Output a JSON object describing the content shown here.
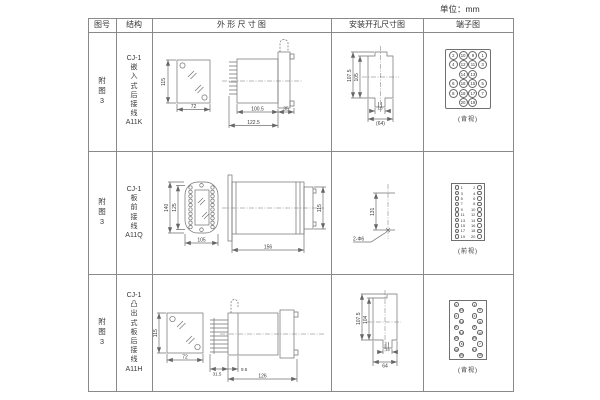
{
  "unit_label": "单位：mm",
  "header": {
    "fig": "图号",
    "struct": "结构",
    "outline": "外 形 尺 寸 图",
    "mount": "安装开孔尺寸图",
    "terminal": "端子图"
  },
  "rows": [
    {
      "fig_no": "附\n图\n3",
      "structure": "CJ-1\n嵌\n入\n式\n后\n接\n线\nA11K",
      "outline": {
        "front_h": "115",
        "front_w": "72",
        "len_body": "100.5",
        "len_total": "122.5",
        "len_flange": "35"
      },
      "mount": {
        "h_outer": "107.5",
        "h_inner": "105",
        "w_slot": "16",
        "w_overall": "(64)"
      },
      "terminal": {
        "caption": "(背视)",
        "grid": [
          {
            "a": "2",
            "b": "10",
            "c": "9",
            "d": "1"
          },
          {
            "a": "4",
            "b": "12",
            "c": "11",
            "d": "3"
          },
          {
            "a": "",
            "b": "14",
            "c": "13",
            "d": ""
          },
          {
            "a": "6",
            "b": "16",
            "c": "15",
            "d": "5"
          },
          {
            "a": "8",
            "b": "18",
            "c": "17",
            "d": "7"
          },
          {
            "a": "",
            "b": "20",
            "c": "19",
            "d": ""
          }
        ]
      }
    },
    {
      "fig_no": "附\n图\n3",
      "structure": "CJ-1\n板\n前\n接\n线\nA11Q",
      "outline": {
        "front_h_outer": "140",
        "front_h_inner": "125",
        "front_w": "105",
        "len_body": "156",
        "body_h": "115"
      },
      "mount": {
        "h_holes": "131",
        "hole_note": "2-Φ6"
      },
      "terminal": {
        "caption": "(前视)",
        "pairs": [
          {
            "l": "1",
            "r": "2"
          },
          {
            "l": "3",
            "r": "4"
          },
          {
            "l": "5",
            "r": "6"
          },
          {
            "l": "7",
            "r": "8"
          },
          {
            "l": "9",
            "r": "10"
          },
          {
            "l": "11",
            "r": "12"
          },
          {
            "l": "13",
            "r": "14"
          },
          {
            "l": "15",
            "r": "16"
          },
          {
            "l": "17",
            "r": "18"
          },
          {
            "l": "19",
            "r": "20"
          }
        ]
      }
    },
    {
      "fig_no": "附\n图\n3",
      "structure": "CJ-1\n凸\n出\n式\n板\n后\n接\n线\nA11H",
      "outline": {
        "front_h": "115",
        "front_w": "72",
        "len_comb": "31.5",
        "len_offset": "9.5",
        "len_body": "126"
      },
      "mount": {
        "h_outer": "107.5",
        "h_inner": "104",
        "w_slot": "16",
        "w_overall": "64"
      },
      "terminal": {
        "caption": "(背视)",
        "pairs": [
          {
            "l": "2",
            "r": "1"
          },
          {
            "l": "10",
            "r": "9"
          },
          {
            "l": "4",
            "r": "3"
          },
          {
            "l": "12",
            "r": "11"
          },
          {
            "l": "6",
            "r": "5"
          },
          {
            "l": "14",
            "r": "13"
          },
          {
            "l": "16",
            "r": "15"
          },
          {
            "l": "8",
            "r": "7"
          },
          {
            "l": "18",
            "r": "17"
          },
          {
            "l": "20",
            "r": "19"
          }
        ]
      }
    }
  ],
  "colors": {
    "table_line": "#8a8a8a",
    "drawing_stroke": "#707070",
    "text": "#3a3a3a"
  }
}
